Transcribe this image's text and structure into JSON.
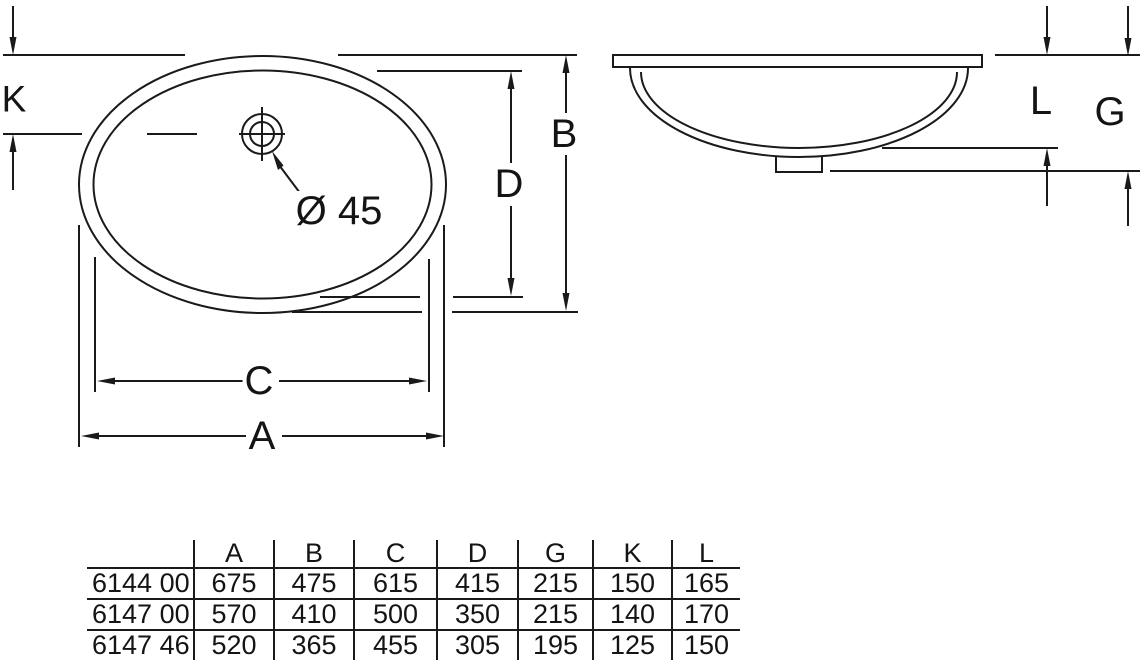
{
  "drawing": {
    "labels": {
      "K": "K",
      "B": "B",
      "D": "D",
      "C": "C",
      "A": "A",
      "L": "L",
      "G": "G",
      "hole_diameter": "Ø 45"
    }
  },
  "table": {
    "headers": [
      "",
      "A",
      "B",
      "C",
      "D",
      "G",
      "K",
      "L"
    ],
    "rows": [
      {
        "model": "6144 00",
        "values": [
          "675",
          "475",
          "615",
          "415",
          "215",
          "150",
          "165"
        ]
      },
      {
        "model": "6147 00",
        "values": [
          "570",
          "410",
          "500",
          "350",
          "215",
          "140",
          "170"
        ]
      },
      {
        "model": "6147 46",
        "values": [
          "520",
          "365",
          "455",
          "305",
          "195",
          "125",
          "150"
        ]
      }
    ]
  },
  "colors": {
    "line": "#1a1a1a",
    "background": "#ffffff"
  }
}
